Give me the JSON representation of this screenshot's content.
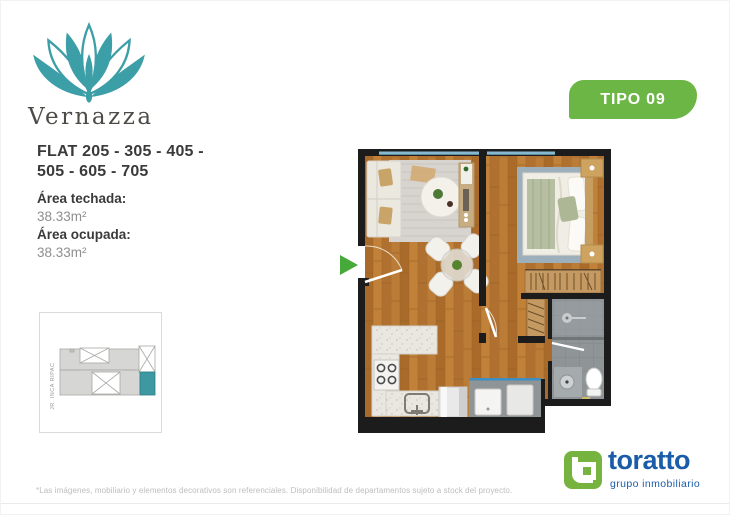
{
  "brand": {
    "name": "Vernazza",
    "accent_color": "#3c9ea7"
  },
  "badge": {
    "label": "TIPO 09",
    "color": "#6cb645"
  },
  "unit": {
    "title_line1": "FLAT 205 - 305 - 405 -",
    "title_line2": "505 - 605 - 705",
    "areas": [
      {
        "label": "Área techada:",
        "value": "38.33m²"
      },
      {
        "label": "Área ocupada:",
        "value": "38.33m²"
      }
    ]
  },
  "site_plan": {
    "street_label": "JR. INCA RIPAC",
    "highlight_color": "#3d98a2"
  },
  "floor_plan": {
    "entry_arrow_color": "#48a93b",
    "wall_color": "#1c1c1c",
    "wood_color": "#b5742f",
    "window_color": "#85b9cf"
  },
  "footer": {
    "disclaimer": "*Las imágenes, mobiliario y elementos decorativos son referenciales. Disponibilidad de departamentos sujeto a stock del proyecto.",
    "logo": {
      "name": "toratto",
      "tagline": "grupo inmobiliario",
      "blue": "#1b5ca8",
      "green": "#77b43f"
    }
  }
}
